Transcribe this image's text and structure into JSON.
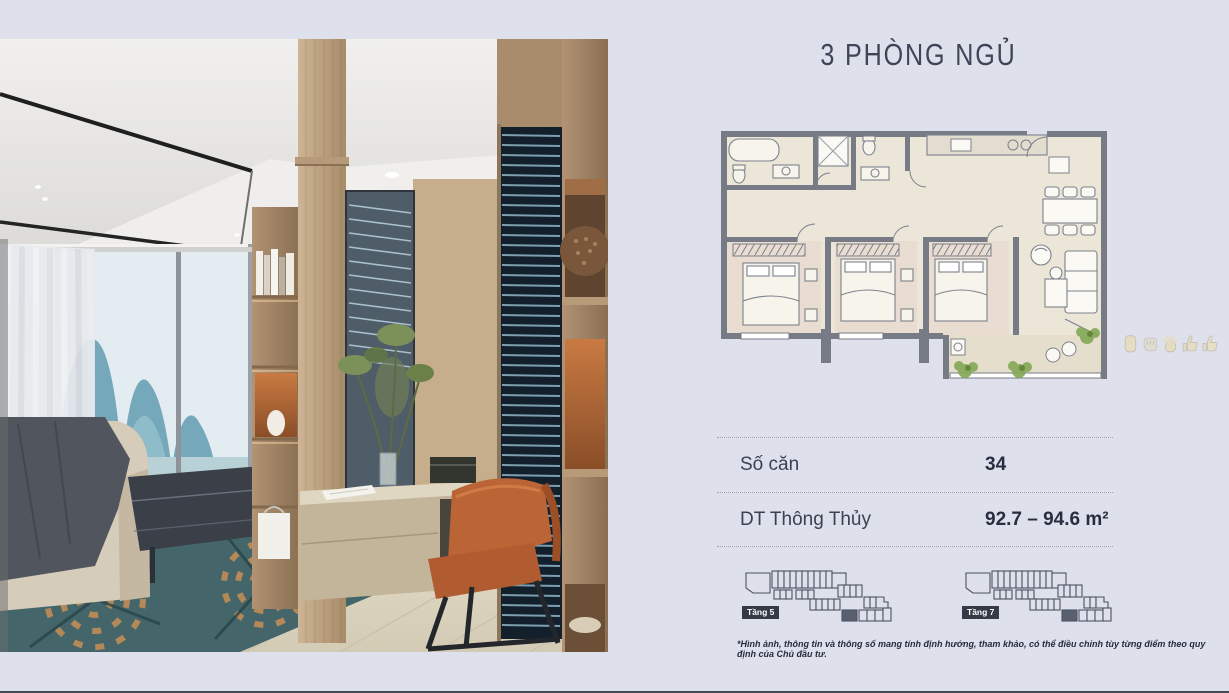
{
  "page": {
    "title": "3 PHÒNG NGỦ",
    "disclaimer": "*Hình ảnh, thông tin và thông số mang tính định hướng, tham khảo, có thể điều chỉnh tùy từng điểm theo quy định của Chủ đầu tư."
  },
  "details": {
    "rows": [
      {
        "label": "Số căn",
        "value": "34"
      },
      {
        "label": "DT Thông Thủy",
        "value": "92.7 – 94.6 m²"
      }
    ]
  },
  "floor_diagrams": [
    {
      "label": "Tầng 5"
    },
    {
      "label": "Tầng 7"
    }
  ],
  "reactions": [
    "raised-hand-icon",
    "fist-icon",
    "open-hand-icon",
    "thumbs-up-icon",
    "thumbs-up-icon"
  ],
  "colors": {
    "background": "#dee1ec",
    "title_text": "#3e4557",
    "badge_background": "#343a46",
    "plan_walls": "#767b86",
    "plan_floor": "#ece6d9",
    "accent_wood": "#b99a77",
    "accent_chair": "#b05c30"
  }
}
